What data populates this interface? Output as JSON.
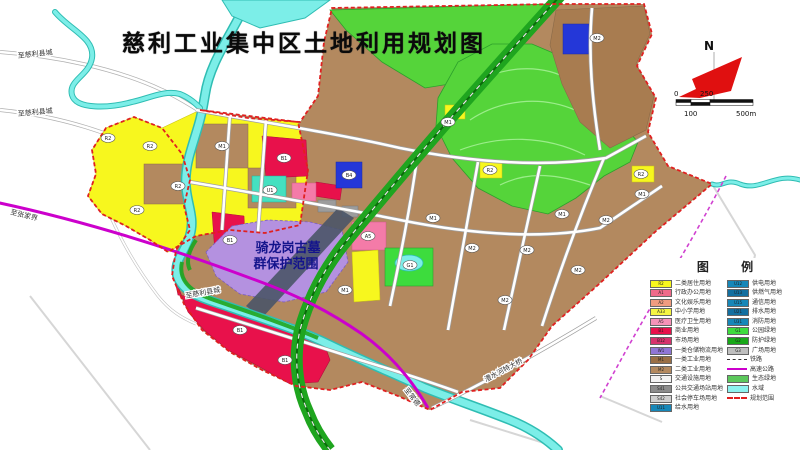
{
  "title": "慈利工业集中区土地利用规划图",
  "north": {
    "label": "N"
  },
  "scale": {
    "t0": "0",
    "t250": "250",
    "b100": "100",
    "b500": "500m"
  },
  "legend": {
    "title": "图 例",
    "left": [
      {
        "label": "二类居住用地",
        "code": "R2",
        "color": "#f7f71e",
        "type": "swatch"
      },
      {
        "label": "行政办公用地",
        "code": "A1",
        "color": "#ef6a8a",
        "type": "swatch"
      },
      {
        "label": "文化娱乐用地",
        "code": "A2",
        "color": "#f09c80",
        "type": "swatch"
      },
      {
        "label": "中小学用地",
        "code": "A33",
        "color": "#f5f542",
        "type": "swatch"
      },
      {
        "label": "医疗卫生用地",
        "code": "A5",
        "color": "#f693b8",
        "type": "swatch"
      },
      {
        "label": "商业用地",
        "code": "B1",
        "color": "#e8114b",
        "type": "swatch"
      },
      {
        "label": "市场用地",
        "code": "B12",
        "color": "#d6336c",
        "type": "swatch"
      },
      {
        "label": "一类仓储物流用地",
        "code": "W1",
        "color": "#8f76d6",
        "type": "swatch"
      },
      {
        "label": "一类工业用地",
        "code": "M1",
        "color": "#9a6f45",
        "type": "swatch"
      },
      {
        "label": "二类工业用地",
        "code": "M2",
        "color": "#b3895f",
        "type": "swatch"
      },
      {
        "label": "交通设施用地",
        "code": "S",
        "color": "#f2f2f2",
        "type": "swatch"
      },
      {
        "label": "公共交通场站用地",
        "code": "S41",
        "color": "#8c8c8c",
        "type": "swatch"
      },
      {
        "label": "社会停车场用地",
        "code": "S42",
        "color": "#cfcfcf",
        "type": "swatch"
      },
      {
        "label": "给水用地",
        "code": "U11",
        "color": "#1787b8",
        "type": "swatch"
      }
    ],
    "right": [
      {
        "label": "供电用地",
        "code": "U12",
        "color": "#1787b8",
        "type": "swatch"
      },
      {
        "label": "供燃气用地",
        "code": "U13",
        "color": "#136fa0",
        "type": "swatch"
      },
      {
        "label": "通信用地",
        "code": "U15",
        "color": "#1787b8",
        "type": "swatch"
      },
      {
        "label": "排水用地",
        "code": "U21",
        "color": "#136fa0",
        "type": "swatch"
      },
      {
        "label": "消防用地",
        "code": "U31",
        "color": "#1787b8",
        "type": "swatch"
      },
      {
        "label": "公园绿地",
        "code": "G1",
        "color": "#3ddc3d",
        "type": "swatch"
      },
      {
        "label": "防护绿地",
        "code": "G2",
        "color": "#18a818",
        "type": "swatch"
      },
      {
        "label": "广场用地",
        "code": "G3",
        "color": "#bfbfbf",
        "type": "swatch"
      },
      {
        "label": "铁路",
        "code": "",
        "color": "#333333",
        "type": "line-dashed"
      },
      {
        "label": "高速公路",
        "code": "",
        "color": "#cc00cc",
        "type": "line-solid"
      },
      {
        "label": "生态绿地",
        "code": "",
        "color": "#5cc85c",
        "type": "swatch"
      },
      {
        "label": "水域",
        "code": "",
        "color": "#8df3ef",
        "type": "swatch"
      },
      {
        "label": "规划范围",
        "code": "",
        "color": "#e02020",
        "type": "line-reddash"
      }
    ]
  },
  "map": {
    "protection_line1": "骑龙岗古墓",
    "protection_line2": "群保护范围",
    "road_labels": [
      {
        "text": "至慈利县城",
        "x": 18,
        "y": 58,
        "rot": -6
      },
      {
        "text": "至慈利县城",
        "x": 18,
        "y": 116,
        "rot": -5
      },
      {
        "text": "至慈利县城",
        "x": 186,
        "y": 298,
        "rot": -10
      },
      {
        "text": "至张家界",
        "x": 10,
        "y": 214,
        "rot": 14
      },
      {
        "text": "至常德",
        "x": 404,
        "y": 390,
        "rot": 52
      },
      {
        "text": "澧水河特大桥",
        "x": 486,
        "y": 382,
        "rot": -28
      }
    ],
    "parcel_codes": [
      {
        "x": 108,
        "y": 138,
        "code": "R2"
      },
      {
        "x": 150,
        "y": 146,
        "code": "R2"
      },
      {
        "x": 178,
        "y": 186,
        "code": "R2"
      },
      {
        "x": 222,
        "y": 146,
        "code": "M1"
      },
      {
        "x": 137,
        "y": 210,
        "code": "R2"
      },
      {
        "x": 270,
        "y": 190,
        "code": "U1"
      },
      {
        "x": 284,
        "y": 158,
        "code": "B1"
      },
      {
        "x": 230,
        "y": 240,
        "code": "B1"
      },
      {
        "x": 349,
        "y": 175,
        "code": "B4"
      },
      {
        "x": 368,
        "y": 236,
        "code": "A5"
      },
      {
        "x": 410,
        "y": 265,
        "code": "G1"
      },
      {
        "x": 433,
        "y": 218,
        "code": "M1"
      },
      {
        "x": 472,
        "y": 248,
        "code": "M2"
      },
      {
        "x": 527,
        "y": 250,
        "code": "M2"
      },
      {
        "x": 562,
        "y": 214,
        "code": "M1"
      },
      {
        "x": 606,
        "y": 220,
        "code": "M2"
      },
      {
        "x": 642,
        "y": 194,
        "code": "M1"
      },
      {
        "x": 597,
        "y": 38,
        "code": "M2"
      },
      {
        "x": 448,
        "y": 122,
        "code": "M1"
      },
      {
        "x": 490,
        "y": 170,
        "code": "R2"
      },
      {
        "x": 641,
        "y": 174,
        "code": "R2"
      },
      {
        "x": 240,
        "y": 330,
        "code": "B1"
      },
      {
        "x": 285,
        "y": 360,
        "code": "B1"
      },
      {
        "x": 345,
        "y": 290,
        "code": "M1"
      },
      {
        "x": 505,
        "y": 300,
        "code": "M2"
      },
      {
        "x": 578,
        "y": 270,
        "code": "M2"
      }
    ]
  },
  "colors": {
    "residential_yellow": "#f7f71e",
    "industry_tan": "#b3895f",
    "industry_brown": "#a87c50",
    "park_green": "#55d43a",
    "corridor_green": "#1fa51f",
    "river_fill": "#7ceee8",
    "river_edge": "#2fbdb3",
    "commercial_red": "#e8114b",
    "pink": "#f47ba8",
    "protection_purple": "#b491e0",
    "blue_parcel": "#2437d8",
    "highway_magenta": "#cc00cc",
    "boundary_red": "#e02020",
    "rail_dark": "#4a5568"
  }
}
